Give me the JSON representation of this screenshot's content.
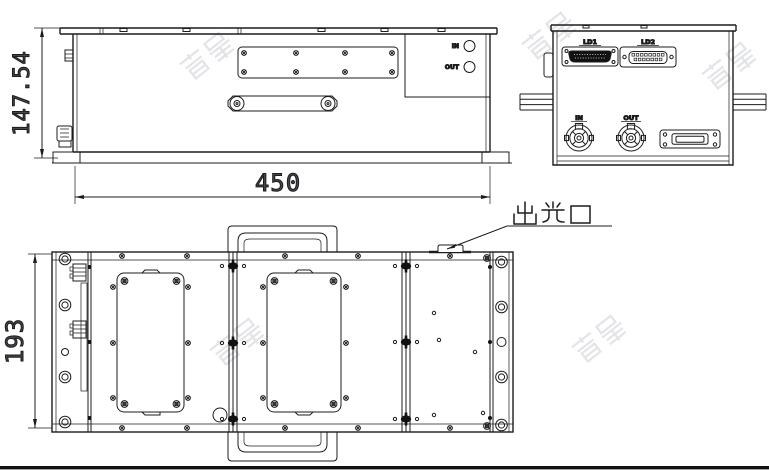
{
  "drawing": {
    "title": "laser-module-outline-drawing",
    "watermark_text": "高慧",
    "colors": {
      "line": "#1c1c1c",
      "dim_text": "#45464e",
      "watermark": "#cbcfd5",
      "background": "#ffffff"
    },
    "side_view": {
      "height_dim": "147.54",
      "width_dim": "450",
      "panel": {
        "in_label": "IN",
        "out_label": "OUT"
      }
    },
    "end_view": {
      "ld1_label": "LD1",
      "ld2_label": "LD2",
      "in_label": "IN",
      "out_label": "OUT"
    },
    "top_view": {
      "height_dim": "193",
      "output_port_label": "出光口"
    }
  }
}
